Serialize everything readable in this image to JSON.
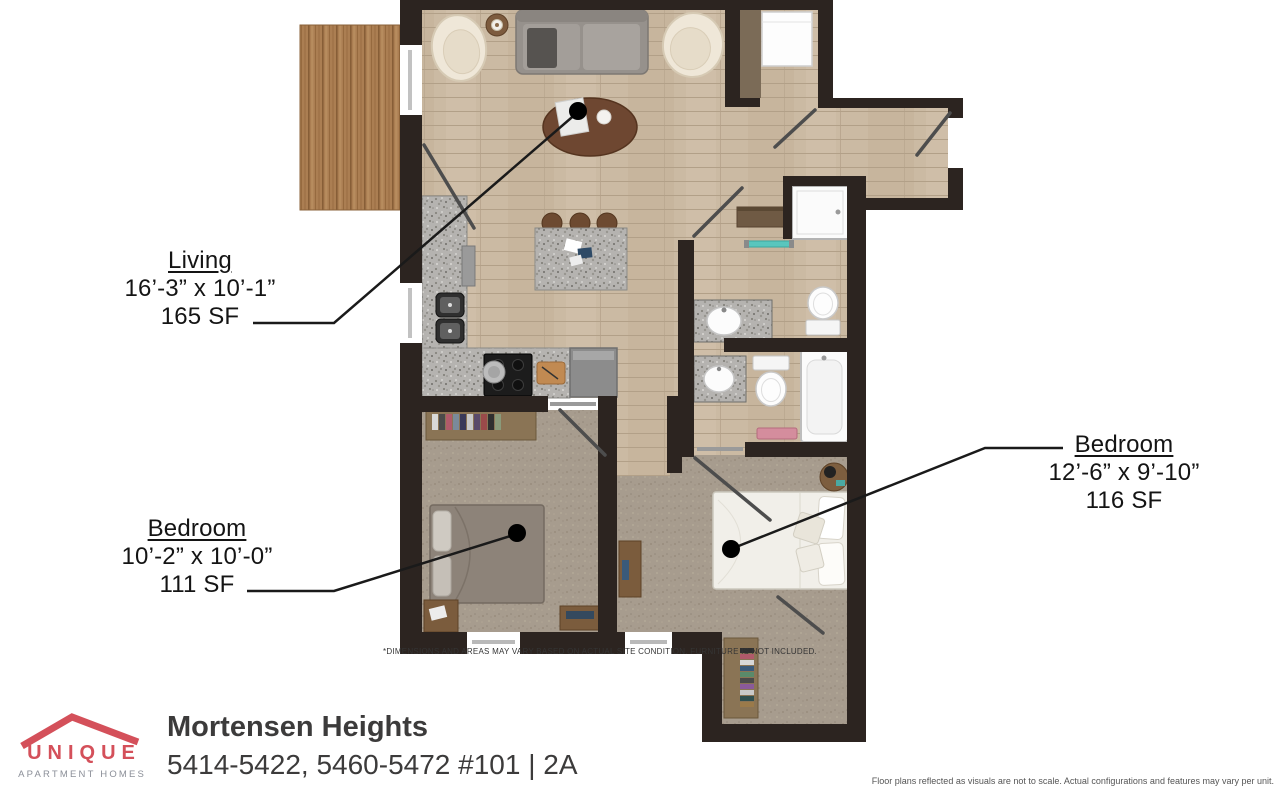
{
  "plan": {
    "labels": {
      "living": {
        "name": "Living",
        "dims": "16’-3” x 10’-1”",
        "area": "165 SF"
      },
      "bedroom1": {
        "name": "Bedroom",
        "dims": "10’-2” x 10’-0”",
        "area": "111 SF"
      },
      "bedroom2": {
        "name": "Bedroom",
        "dims": "12’-6” x 9’-10”",
        "area": "116 SF"
      }
    },
    "disclaimer": "*DIMENSIONS AND AREAS MAY VARY BASED ON ACTUAL SITE CONDITION. FURNITURE IS NOT INCLUDED.",
    "rooms_summary": {
      "unit_type": "2 Bedroom / 2A",
      "fixtures": [
        "sofa",
        "armchairs",
        "coffee-table",
        "kitchen-island",
        "stools",
        "double-sink",
        "stove",
        "fridge",
        "washer-dryer",
        "shower",
        "bathtub",
        "two-toilets",
        "two-bath-sinks",
        "beds",
        "closets",
        "deck"
      ]
    }
  },
  "footer": {
    "brand": {
      "name": "UNIQUE",
      "tagline": "APARTMENT HOMES"
    },
    "property_name": "Mortensen Heights",
    "property_address": "5414-5422, 5460-5472 #101 | 2A",
    "legal": "Floor plans reflected as visuals are not to scale. Actual configurations and features may vary per unit."
  },
  "colors": {
    "accent": "#d4505a",
    "brand_gray": "#8b8f98",
    "wall": "#2c2420",
    "wood_floor": "#cbbaa3",
    "deck_wood": "#ab7e52",
    "carpet": "#a79c8e",
    "granite": "#b5b3b0",
    "label_text": "#141414"
  }
}
